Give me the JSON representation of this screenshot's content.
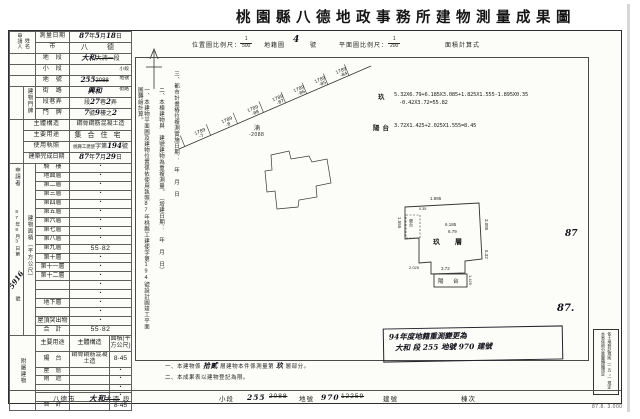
{
  "title": "桃園縣八德地政事務所建物測量成果圖",
  "header": {
    "loc_scale_label": "位置圖比例尺：",
    "loc_num": "1",
    "loc_den": "500",
    "cad_label": "地籍圖",
    "cad_no": "4",
    "cad_unit": "號",
    "plan_scale_label": "平面圖比例尺：",
    "plan_num": "1",
    "plan_den": "200",
    "calc_label": "面積計算式"
  },
  "applicant_box": {
    "col1": "申請人",
    "col2": "姓名"
  },
  "left_margin": {
    "top": "申請者",
    "date": "87年8月3日",
    "no_prefix": "第",
    "no_hand": "5916",
    "no_suffix": "號"
  },
  "door_group_label": "建物門牌",
  "area_group_label": "建物面積（平方公尺）",
  "survey_info_rows": [
    {
      "label": "測量日期",
      "segs": [
        {
          "t": "87",
          "h": 1
        },
        {
          "t": "年"
        },
        {
          "t": "5",
          "h": 1
        },
        {
          "t": "月"
        },
        {
          "t": "18",
          "h": 1
        },
        {
          "t": "日"
        }
      ]
    },
    {
      "label": "市",
      "segs": [
        {
          "t": "八　德",
          "big": 1
        }
      ]
    },
    {
      "label": "地　段",
      "segs": [
        {
          "t": "大和",
          "h": 1
        },
        {
          "t": "大湳一",
          "s": 1
        },
        {
          "t": "段"
        }
      ]
    },
    {
      "label": "小　段",
      "segs": [
        {
          "t": "小段",
          "u": 1
        }
      ]
    },
    {
      "label": "地　號",
      "segs": [
        {
          "t": "255",
          "h": 1
        },
        {
          "t": "2088",
          "s": 1
        },
        {
          "t": "地號",
          "u": 1
        }
      ]
    },
    {
      "label": "街　路",
      "segs": [
        {
          "t": "興和",
          "h": 1
        },
        {
          "t": "街路",
          "u": 1
        }
      ]
    },
    {
      "label": "段巷弄",
      "segs": [
        {
          "t": "段"
        },
        {
          "t": "27",
          "h": 1
        },
        {
          "t": "巷"
        },
        {
          "t": "2",
          "h": 1
        },
        {
          "t": "弄"
        }
      ]
    },
    {
      "label": "門　牌",
      "segs": [
        {
          "t": "7",
          "h": 1
        },
        {
          "t": "號"
        },
        {
          "t": "9",
          "h": 1
        },
        {
          "t": "樓之"
        },
        {
          "t": "2",
          "h": 1
        }
      ]
    },
    {
      "label": "主體構造",
      "segs": [
        {
          "t": "鋼骨鋼筋混凝土造"
        }
      ]
    },
    {
      "label": "主要用途",
      "segs": [
        {
          "t": "集合住宅",
          "big": 1
        }
      ]
    },
    {
      "label": "使用執照",
      "segs": [
        {
          "t": "桃縣工建使",
          "sm": 1
        },
        {
          "t": "字第"
        },
        {
          "t": "194",
          "h": 1
        },
        {
          "t": "號"
        }
      ]
    },
    {
      "label": "建築完成日期",
      "segs": [
        {
          "t": "87",
          "h": 1
        },
        {
          "t": "年"
        },
        {
          "t": "7",
          "h": 1
        },
        {
          "t": "月"
        },
        {
          "t": "29",
          "h": 1
        },
        {
          "t": "日"
        }
      ]
    }
  ],
  "area_rows": [
    {
      "label": "騎　樓",
      "value": "・"
    },
    {
      "label": "地面層",
      "value": "・"
    },
    {
      "label": "第二層",
      "value": "・"
    },
    {
      "label": "第三層",
      "value": "・"
    },
    {
      "label": "第四層",
      "value": "・"
    },
    {
      "label": "第五層",
      "value": "・"
    },
    {
      "label": "第六層",
      "value": "・"
    },
    {
      "label": "第七層",
      "value": "・"
    },
    {
      "label": "第八層",
      "value": "・"
    },
    {
      "label": "第九層",
      "value": "55·82"
    },
    {
      "label": "第十層",
      "value": "・"
    },
    {
      "label": "第十一層",
      "value": "・"
    },
    {
      "label": "第十二層",
      "value": "・"
    },
    {
      "label": "",
      "value": "・"
    },
    {
      "label": "",
      "value": "・"
    },
    {
      "label": "地下層",
      "value": "・"
    },
    {
      "label": "",
      "value": "・"
    },
    {
      "label": "屋頂突出物",
      "value": "・"
    },
    {
      "label": "合　計",
      "value": "55·82"
    }
  ],
  "attached": {
    "group": "附屬建物",
    "headers": [
      "主要用途",
      "主體構造",
      "面積(平方公尺)"
    ],
    "rows": [
      {
        "use": "陽　台",
        "structure": "鋼骨鋼筋混凝土造",
        "area": "8·45"
      },
      {
        "use": "屋　簷",
        "structure": "",
        "area": "・"
      },
      {
        "use": "雨　遮",
        "structure": "",
        "area": "・"
      },
      {
        "use": "",
        "structure": "",
        "area": "・"
      },
      {
        "use": "",
        "structure": "",
        "area": "・"
      },
      {
        "use": "合　計",
        "structure": "",
        "area": "8·45"
      }
    ]
  },
  "notes_vertical": [
    "一、本建物平面圖及建物位置係依使用執照87年桃縣工建使字第194號設計圖竣工平面圖轉繪計算。",
    "二、本棟建物與　建號建物為重複測量。（增建日期：　年　月　日）",
    "三、都市計畫樁位複測實施日期：　年　月　日"
  ],
  "location_map": {
    "lots": [
      [
        "1789",
        "-7"
      ],
      [
        "1789",
        "-8"
      ],
      [
        "1789",
        "-88"
      ],
      [
        "1789",
        "-87"
      ],
      [
        "1789",
        "-86"
      ],
      [
        "1789",
        "-85"
      ],
      [
        "1789",
        "-84"
      ]
    ],
    "parcel_char": "湳",
    "parcel_no": "-2088"
  },
  "calc": {
    "r1_label": "玖",
    "r1_line1": "5.32X6.79+6.185X3.085+1.825X1.555-1.895X0.35",
    "r1_line2": "-0.42X3.72=55.82",
    "r2_label": "陽台",
    "r2_line1": "3.72X1.425+2.025X1.555=8.45"
  },
  "floor_plan": {
    "room": "玖　層",
    "balcony": "陽　台",
    "small_box": "陽台",
    "dims": {
      "top": "1.895",
      "w1": "6.185",
      "w2": "6.79",
      "right": "5.32",
      "right_up": "3.085",
      "left": "1.555",
      "left2": "2.025",
      "bottom": "3.72",
      "balcony_side": "1.425",
      "notch": "0.35"
    }
  },
  "stamp": {
    "line1": "94年度地籍重測變更為",
    "line2": "大和 段 255 地號 970 建號"
  },
  "margin_marks": {
    "mark1": "87",
    "mark2": "87."
  },
  "right_box": {
    "col1": "依土地登記規則（一五○）規定",
    "col2": "本案係照分層圖轉繪規定"
  },
  "footer": {
    "segs": [
      {
        "t": "八德市"
      },
      {
        "t": "大和",
        "h": 1
      },
      {
        "t": "大湳",
        "s": 1
      },
      {
        "t": "段"
      },
      {
        "t": "小段"
      },
      {
        "t": "255",
        "h": 1
      },
      {
        "t": "2088",
        "s": 1
      },
      {
        "t": "地號"
      },
      {
        "t": "970",
        "h": 1
      },
      {
        "t": "12259",
        "s": 1
      },
      {
        "t": "建號"
      },
      {
        "t": "棟次"
      }
    ]
  },
  "bottom_notes": {
    "n1_pre": "一、本建物係",
    "n1_hand1": "拾貳",
    "n1_mid": "層建物本件係測量第",
    "n1_hand2": "玖",
    "n1_post": "層部分。",
    "n2": "二、本成果表以建物登記為限。"
  },
  "print_code": "87.8. 3.000"
}
